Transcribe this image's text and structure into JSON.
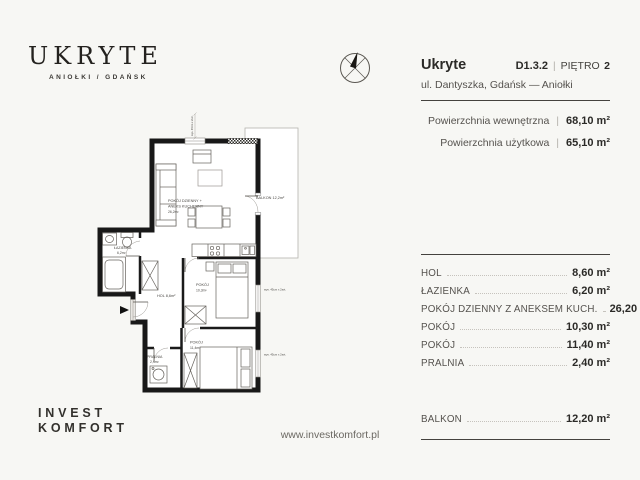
{
  "page": {
    "background": "#f7f7f4",
    "rule_color": "#44423e",
    "wall_color": "#181818"
  },
  "brand": {
    "logo": "UKRYTE",
    "tagline": "ANIOŁKI / GDAŃSK"
  },
  "icons": {
    "compass": "compass-rose-icon",
    "entrance": "entrance-arrow-icon"
  },
  "unit_header": {
    "project": "Ukryte",
    "unit_id": "D1.3.2",
    "separator": "|",
    "floor_label": "PIĘTRO",
    "floor_value": "2",
    "address": "ul. Dantyszka, Gdańsk — Aniołki"
  },
  "summary": [
    {
      "label": "Powierzchnia wewnętrzna",
      "value": "68,10",
      "unit": "m²"
    },
    {
      "label": "Powierzchnia użytkowa",
      "value": "65,10",
      "unit": "m²"
    }
  ],
  "rooms": [
    {
      "label": "HOL",
      "value": "8,60",
      "unit": "m²"
    },
    {
      "label": "ŁAZIENKA",
      "value": "6,20",
      "unit": "m²"
    },
    {
      "label": "POKÓJ DZIENNY Z ANEKSEM KUCH.",
      "value": "26,20",
      "unit": "m²"
    },
    {
      "label": "POKÓJ",
      "value": "10,30",
      "unit": "m²"
    },
    {
      "label": "POKÓJ",
      "value": "11,40",
      "unit": "m²"
    },
    {
      "label": "PRALNIA",
      "value": "2,40",
      "unit": "m²"
    }
  ],
  "balcony": {
    "label": "BALKON",
    "value": "12,20",
    "unit": "m²"
  },
  "floorplan": {
    "living_line1": "POKÓJ DZIENNY +",
    "living_line2": "ANEKS KUCHENNY",
    "living_area": "26,2m²",
    "bathroom_label": "ŁAZIENKA",
    "bathroom_area": "6,2m²",
    "hall_label": "HOL 8,6m²",
    "bedroom1_label": "POKÓJ",
    "bedroom1_area": "10,3m²",
    "bedroom2_label": "POKÓJ",
    "bedroom2_area": "11,4m²",
    "laundry_label": "PRALNIA",
    "laundry_area": "2,4m²",
    "balcony_label": "BALKON 12,2m²",
    "window_note": "wys. 45cm x 2szt."
  },
  "footer": {
    "company_line1": "INVEST",
    "company_line2": "KOMFORT",
    "website": "www.investkomfort.pl"
  }
}
